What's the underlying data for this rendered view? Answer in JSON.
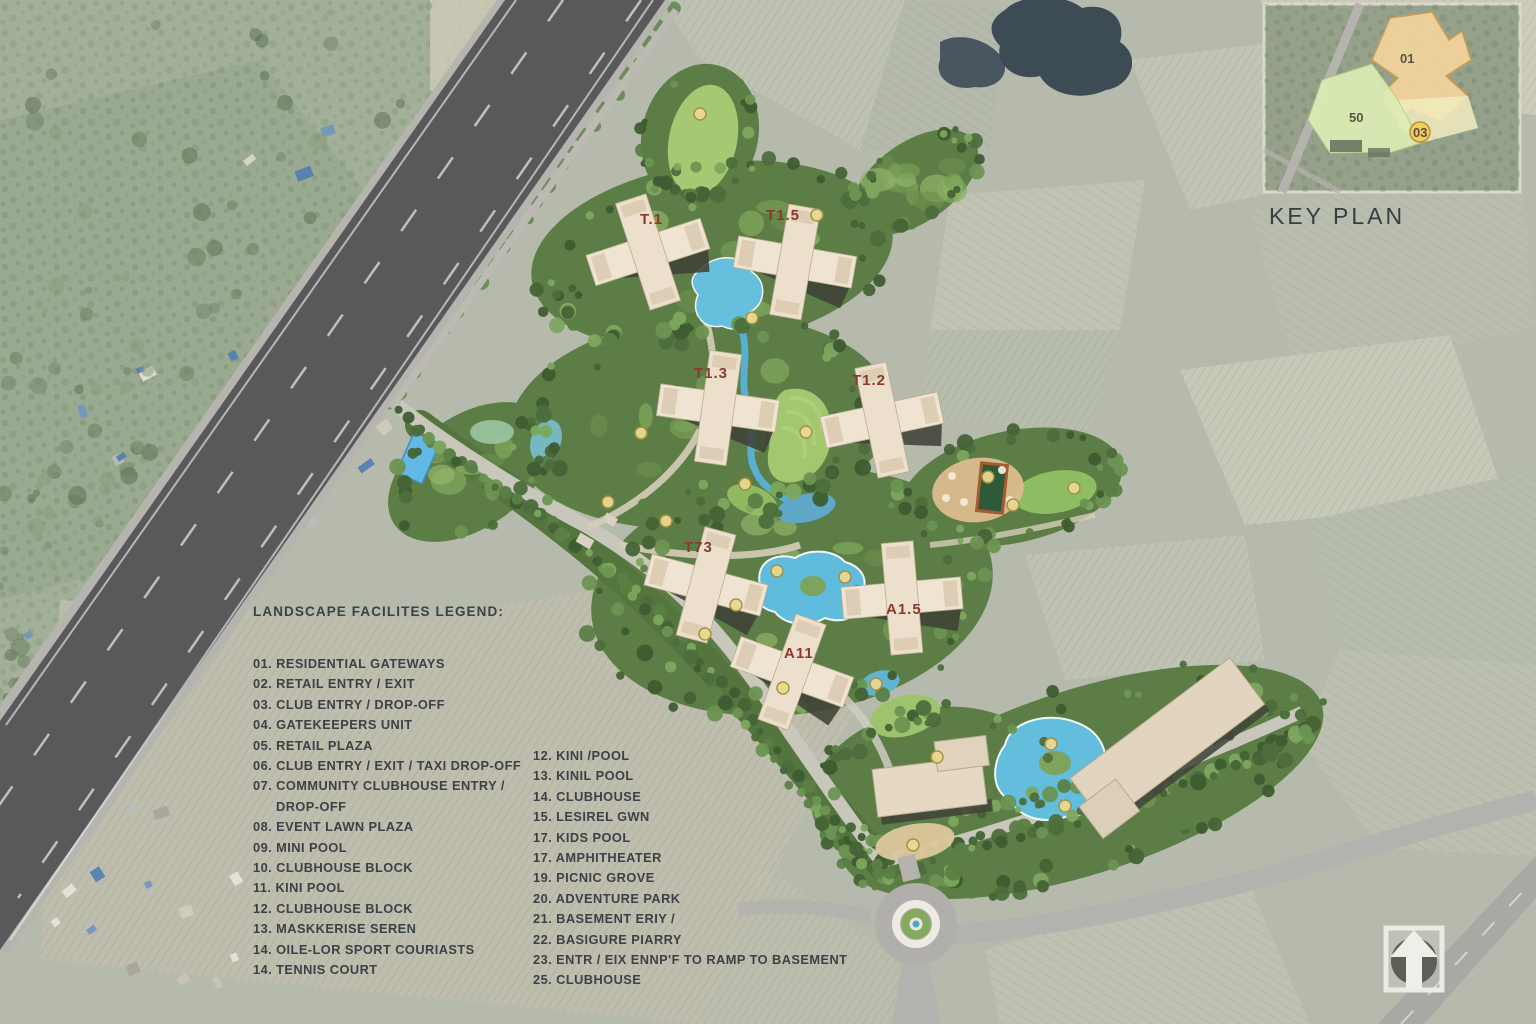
{
  "legend": {
    "title": "LANDSCAPE FACILITES LEGEND:",
    "columns": [
      {
        "items": [
          {
            "num": "01.",
            "text": "RESIDENTIAL GATEWAYS"
          },
          {
            "num": "02.",
            "text": "RETAIL ENTRY / EXIT"
          },
          {
            "num": "03.",
            "text": "CLUB ENTRY / DROP-OFF"
          },
          {
            "num": "04.",
            "text": "GATEKEEPERS UNIT"
          },
          {
            "num": "05.",
            "text": "RETAIL PLAZA"
          },
          {
            "num": "06.",
            "text": "CLUB ENTRY / EXIT / TAXI DROP-OFF"
          },
          {
            "num": "07.",
            "text": "COMMUNITY CLUBHOUSE ENTRY /",
            "cont": "DROP-OFF"
          },
          {
            "num": "08.",
            "text": "EVENT LAWN PLAZA"
          },
          {
            "num": "09.",
            "text": "MINI POOL"
          },
          {
            "num": "10.",
            "text": "CLUBHOUSE BLOCK"
          },
          {
            "num": "11.",
            "text": "KINI POOL"
          },
          {
            "num": "12.",
            "text": "CLUBHOUSE BLOCK"
          },
          {
            "num": "13.",
            "text": "MASKKERISE SEREN"
          },
          {
            "num": "14.",
            "text": "OILE-LOR SPORT COURIASTS"
          },
          {
            "num": "14.",
            "text": "TENNIS COURT"
          }
        ]
      },
      {
        "items": [
          {
            "num": "12.",
            "text": "KINI /POOL"
          },
          {
            "num": "13.",
            "text": "KINIL POOL"
          },
          {
            "num": "14.",
            "text": "CLUBHOUSE"
          },
          {
            "num": "15.",
            "text": "LESIREL GWN"
          },
          {
            "num": "17.",
            "text": "KIDS POOL"
          },
          {
            "num": "17.",
            "text": "AMPHITHEATER"
          },
          {
            "num": "19.",
            "text": "PICNIC GROVE"
          },
          {
            "num": "20.",
            "text": "ADVENTURE PARK"
          },
          {
            "num": "21.",
            "text": "BASEMENT ERIY /"
          },
          {
            "num": "22.",
            "text": "BASIGURE PIARRY"
          },
          {
            "num": "23.",
            "text": "ENTR / EIX ENNP'F TO RAMP TO BASEMENT"
          },
          {
            "num": "25.",
            "text": "CLUBHOUSE"
          }
        ]
      }
    ]
  },
  "key_plan": {
    "label": "KEY PLAN",
    "parcels": [
      {
        "label": "01"
      },
      {
        "label": "50"
      },
      {
        "label": "03"
      }
    ]
  },
  "site": {
    "towers": [
      {
        "label": "T.1"
      },
      {
        "label": "T1.5"
      },
      {
        "label": "T1.3"
      },
      {
        "label": "T1.2"
      },
      {
        "label": "T73"
      },
      {
        "label": "A1.5"
      },
      {
        "label": "A11"
      }
    ]
  },
  "colors": {
    "site_green": "#5c7d45",
    "lawn": "#a3c76f",
    "water": "#5fbcdc",
    "highway": "#59595b",
    "building_cream": "#efe3d1",
    "tower_label_red": "#8a3a2b",
    "legend_text": "#3c4147",
    "parcel_orange": "#f4d49e",
    "parcel_green": "#dcedb6",
    "badge_yellow": "#f3cd5e"
  }
}
